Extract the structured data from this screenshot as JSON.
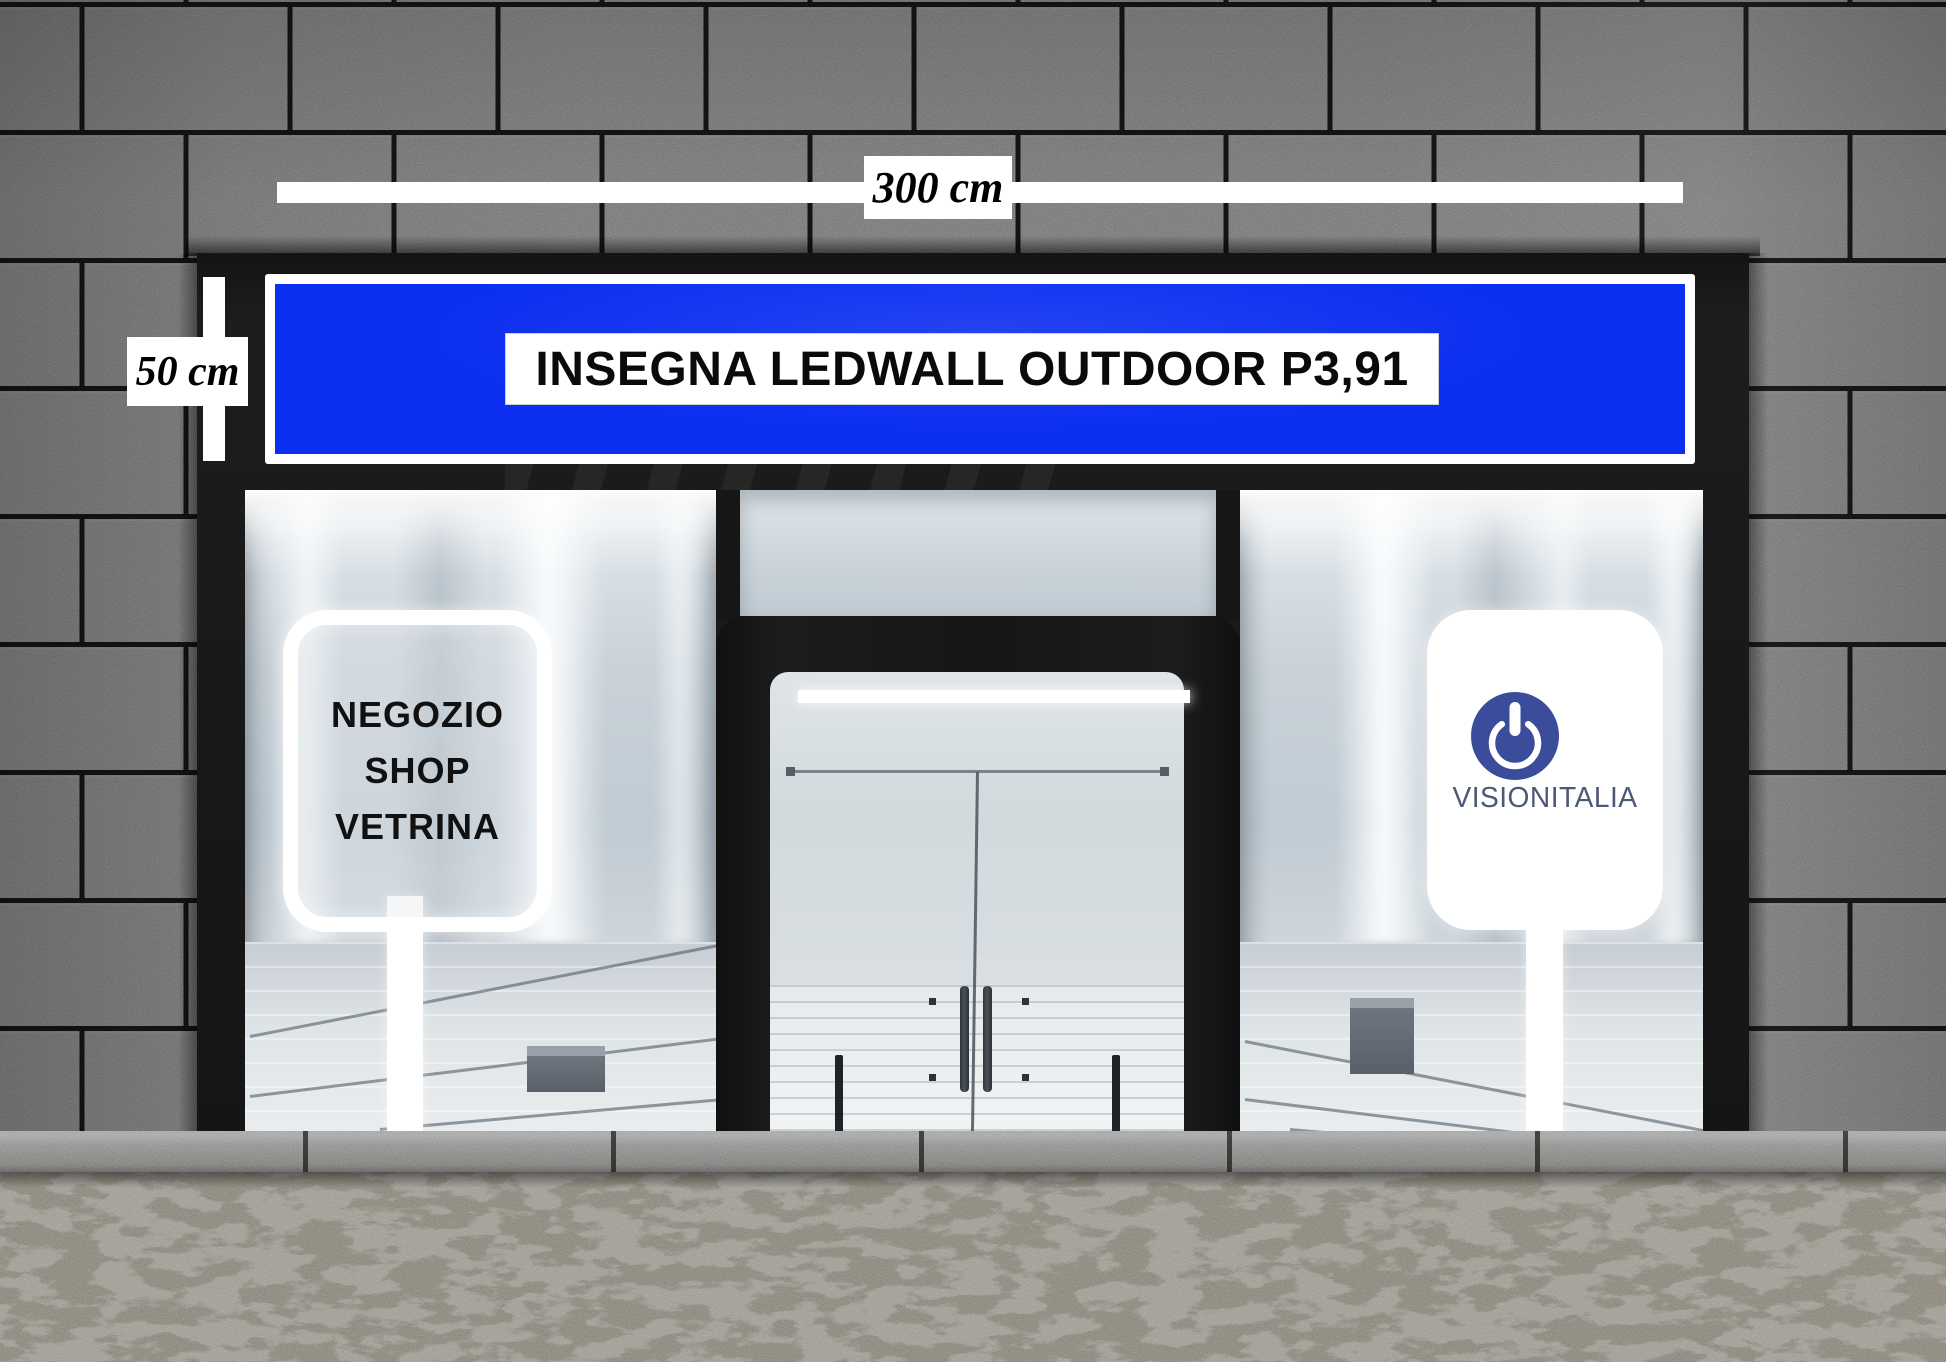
{
  "measurements": {
    "width_label": "300 cm",
    "height_label": "50 cm"
  },
  "banner": {
    "text": "INSEGNA LEDWALL OUTDOOR P3,91"
  },
  "left_sign": {
    "line1": "NEGOZIO",
    "line2": "SHOP",
    "line3": "VETRINA"
  },
  "right_sign": {
    "brand": "VISIONITALIA"
  },
  "icons": {
    "logo": "power-icon"
  },
  "colors": {
    "banner_blue": "#0b2ef0",
    "logo_blue": "#3b4c9a",
    "brand_text": "#4d5878",
    "measure_white": "#ffffff",
    "facade_black": "#1a1a1a",
    "wall_gray": "#747474"
  }
}
